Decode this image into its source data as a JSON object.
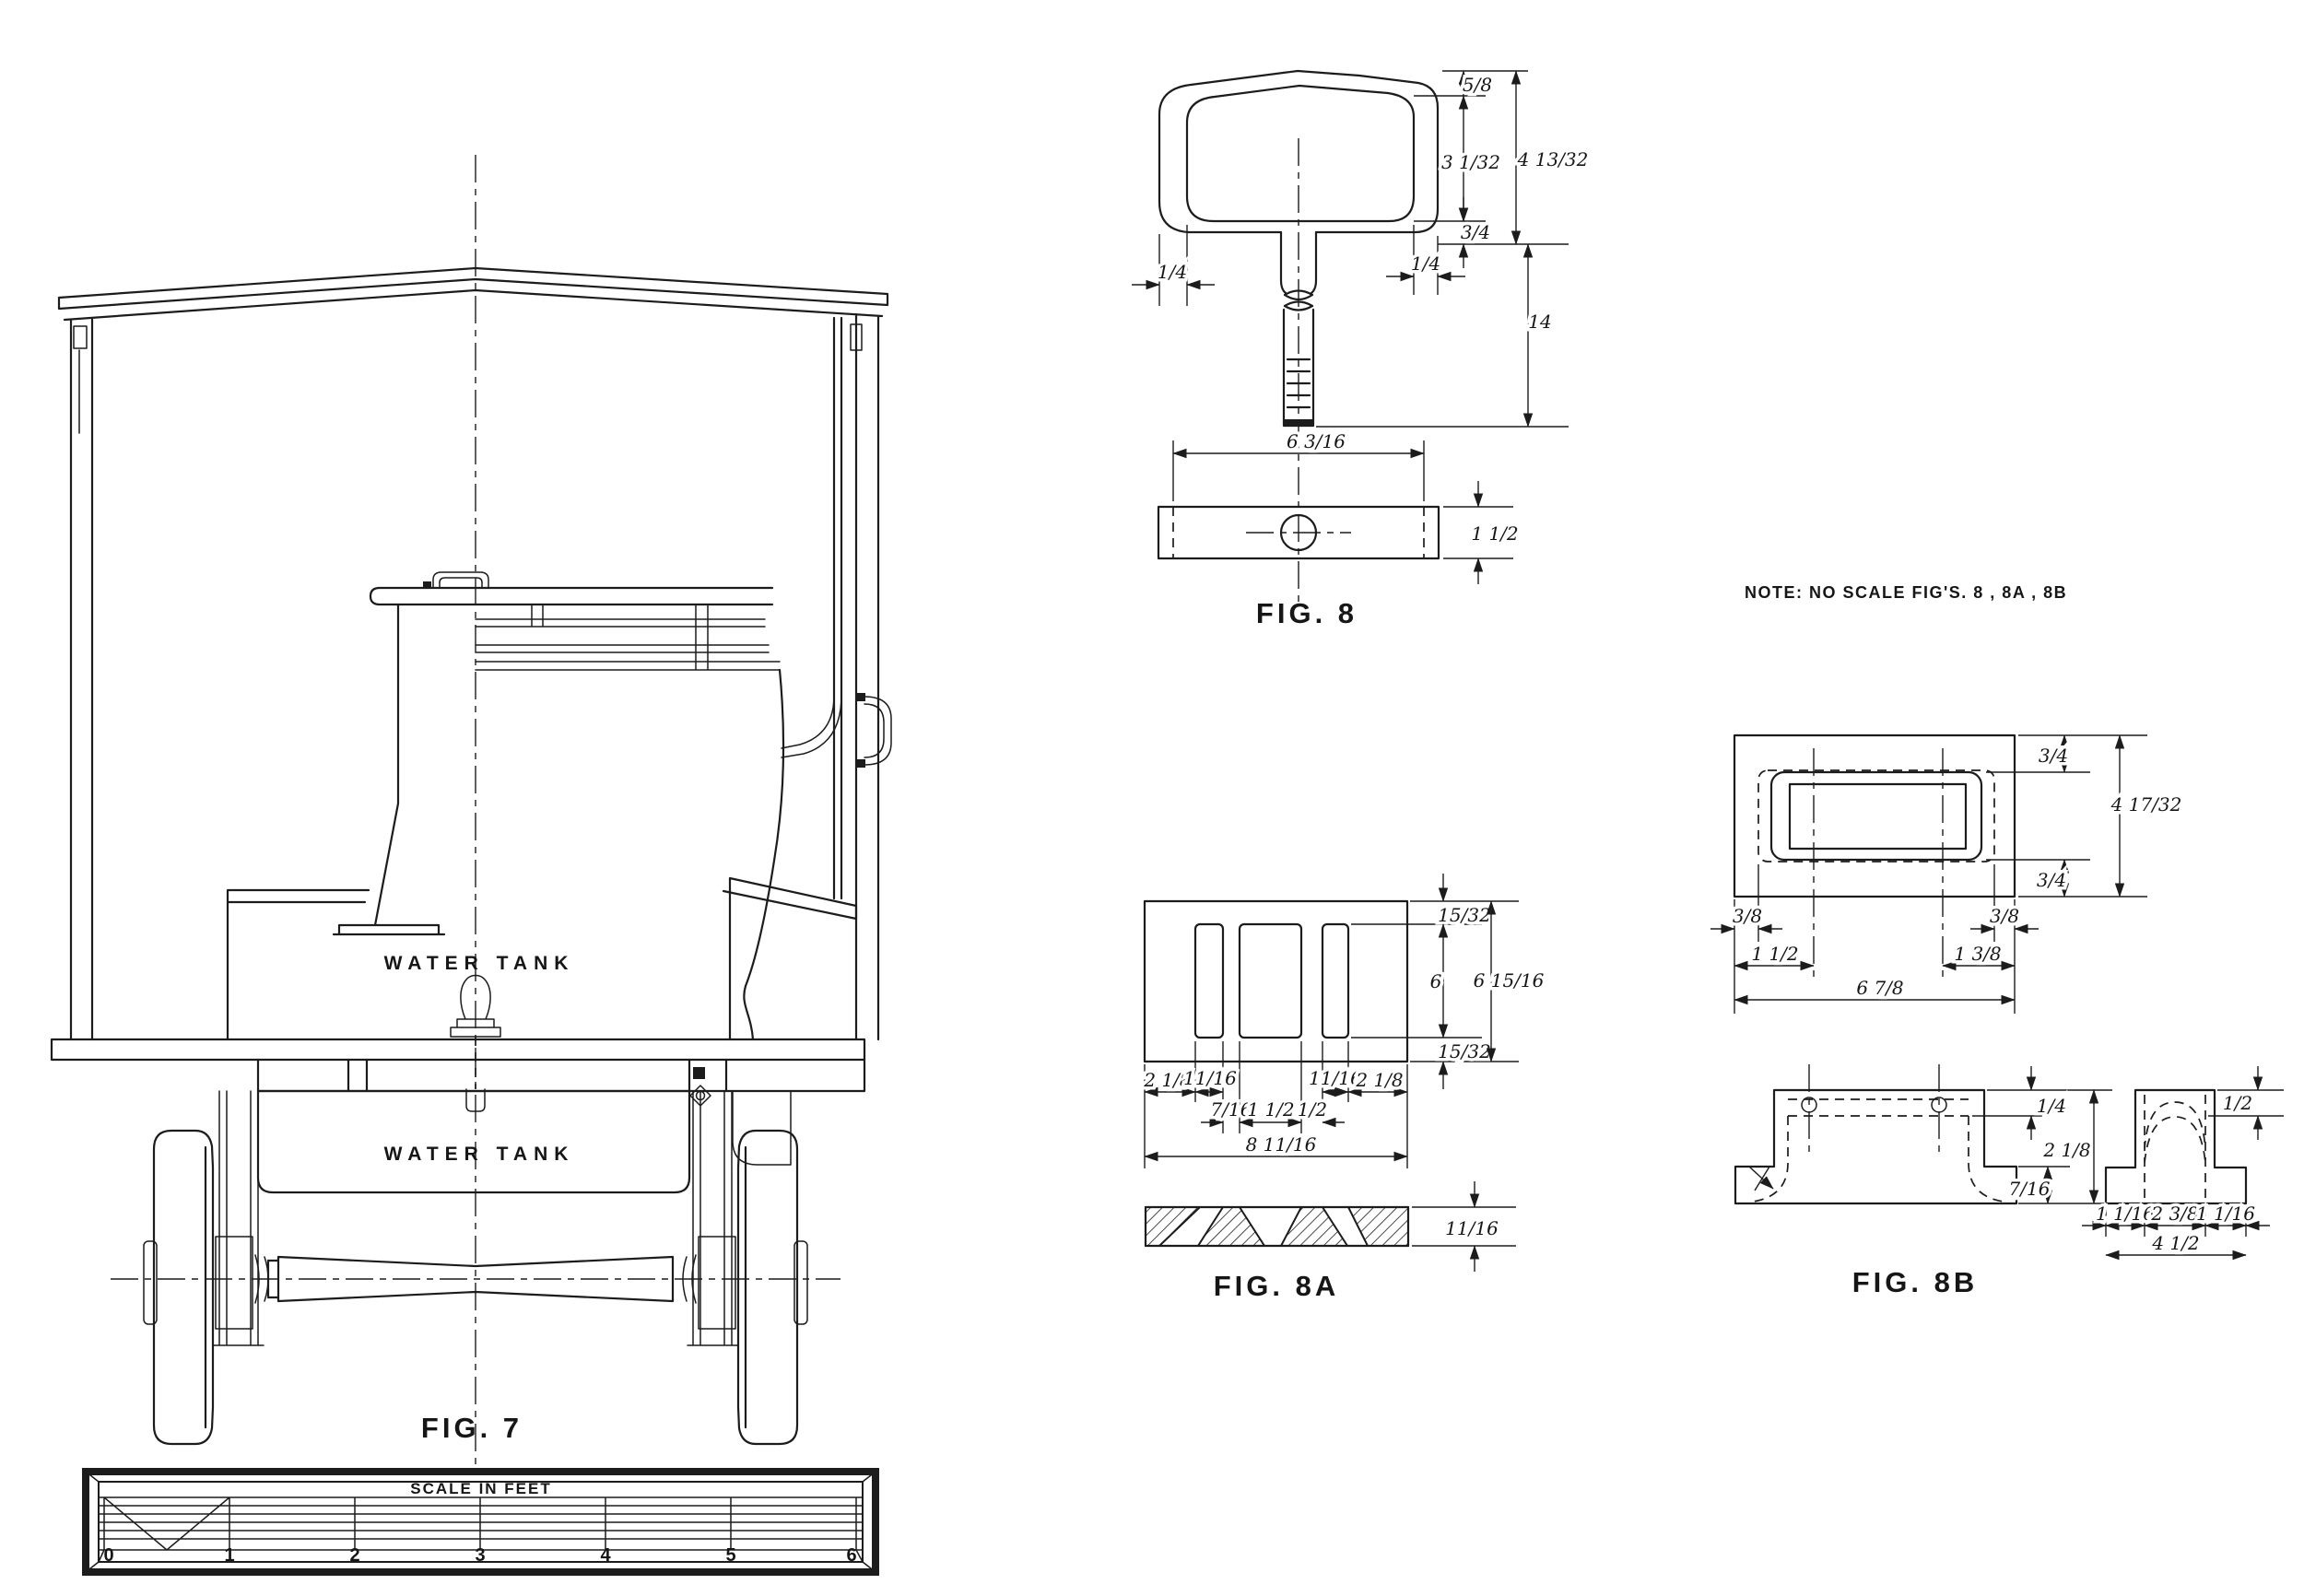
{
  "note": {
    "text": "NOTE:   NO SCALE FIG'S.   8 , 8A , 8B"
  },
  "fig7": {
    "label": "FIG. 7",
    "upper_tank_label": "WATER TANK",
    "lower_tank_label": "WATER TANK",
    "scale_bar": {
      "title": "SCALE IN FEET",
      "ticks": [
        "0",
        "1",
        "2",
        "3",
        "4",
        "5",
        "6"
      ]
    }
  },
  "fig8": {
    "label": "FIG. 8",
    "dims": {
      "lip": "5/8",
      "opening_depth": "3 1/32",
      "head_depth": "4 13/32",
      "boss": "3/4",
      "wall_left": "1/4",
      "wall_right": "1/4",
      "overall_length": "14",
      "base_width": "6 3/16",
      "base_thickness": "1 1/2"
    }
  },
  "fig8a": {
    "label": "FIG. 8A",
    "dims": {
      "margin_top": "15/32",
      "slot_length": "6",
      "margin_bottom": "15/32",
      "overall_height": "6 15/16",
      "end_left": "2 1/8",
      "web_left": "11/16",
      "web_right": "11/16",
      "end_right": "2 1/8",
      "slot_left_width": "7/16",
      "slot_center_width": "1 1/2",
      "slot_right_width": "1/2",
      "overall_width": "8 11/16",
      "thickness": "11/16"
    }
  },
  "fig8b": {
    "label": "FIG. 8B",
    "top_view_dims": {
      "margin_top": "3/4",
      "overall_height": "4 17/32",
      "margin_bottom": "3/4",
      "offset_left": "3/8",
      "offset_right": "3/8",
      "hole_left": "1 1/2",
      "hole_right": "1 3/8",
      "overall_width": "6 7/8"
    },
    "front_view_dims": {
      "lip": "1/4",
      "overall_height": "2 1/8",
      "base": "7/16"
    },
    "side_view_dims": {
      "lip": "1/2",
      "flange_left": "1 1/16",
      "body_width": "2 3/8",
      "flange_right": "1 1/16",
      "overall_width": "4 1/2"
    }
  }
}
